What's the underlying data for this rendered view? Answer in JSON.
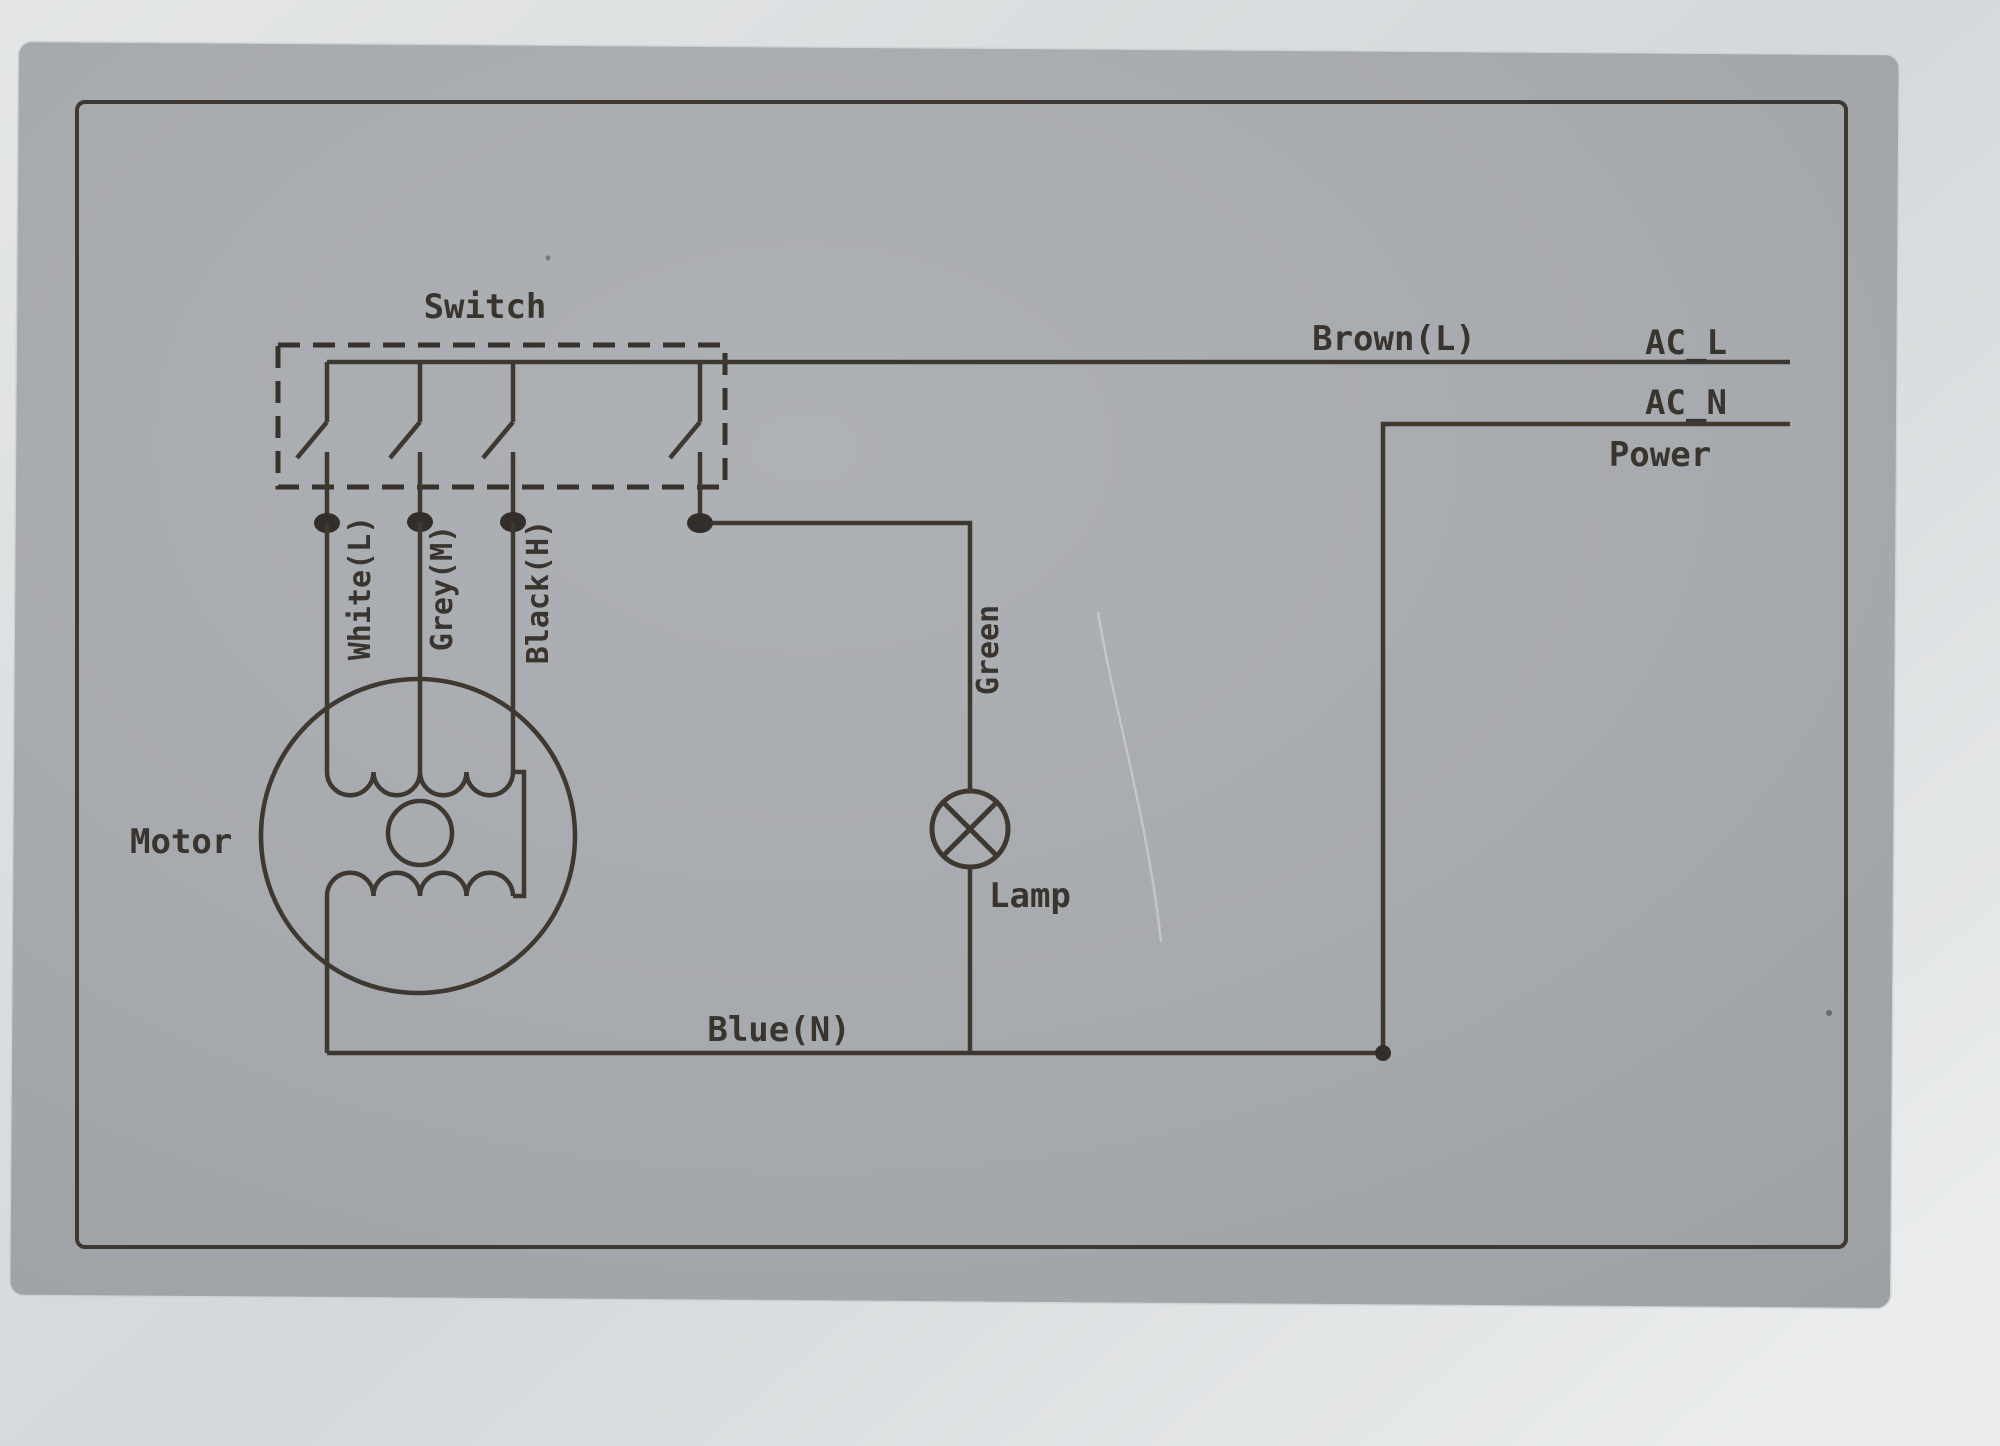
{
  "diagram": {
    "kind": "appliance wiring diagram (scanned card)",
    "labels": {
      "switch": "Switch",
      "brown_line": "Brown(L)",
      "ac_l": "AC_L",
      "ac_n": "AC_N",
      "power": "Power",
      "wire_white": "White(L)",
      "wire_grey": "Grey(M)",
      "wire_black": "Black(H)",
      "wire_green": "Green",
      "lamp": "Lamp",
      "motor": "Motor",
      "wire_blue": "Blue(N)"
    },
    "components": {
      "switch_poles": 4,
      "motor_windings": 2,
      "lamp_count": 1
    },
    "colors": {
      "ink": "#3e3831",
      "card": "#a7aaae",
      "background": "#dee1e2"
    }
  }
}
